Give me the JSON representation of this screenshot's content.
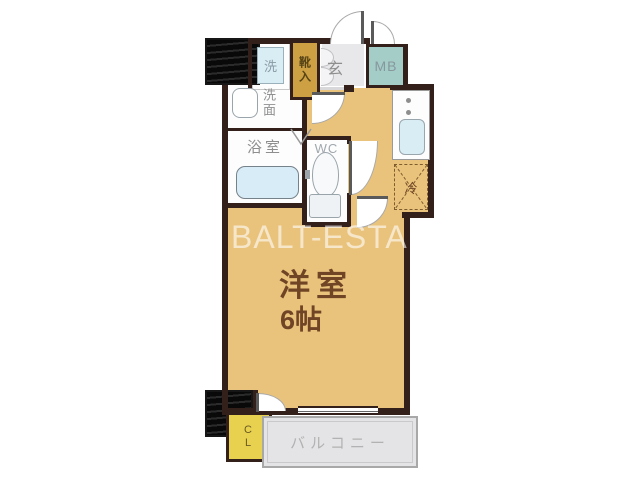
{
  "watermark": "BALT-ESTA",
  "rooms": {
    "main_room": {
      "name": "洋室",
      "size": "6帖"
    },
    "entrance": "玄",
    "meter_box": "MB",
    "washing_machine": "洗",
    "shoe_cabinet": "靴入",
    "washroom": "洗面",
    "bathroom": "浴室",
    "toilet": "WC",
    "refrigerator": "冷",
    "closet": "CL",
    "balcony": "バルコニー"
  },
  "colors": {
    "wall": "#33201a",
    "floor_tan": "#e9c37c",
    "closet_yellow": "#e8d14f",
    "shoe_box_gold": "#cda044",
    "meter_box_teal": "#a5cdc7",
    "water_blue": "#d9edf5",
    "balcony_gray": "#e4e4e6",
    "room_text_brown": "#6f4526",
    "label_gray": "#8e8e8e",
    "watermark_white": "rgba(255,255,255,0.6)"
  }
}
